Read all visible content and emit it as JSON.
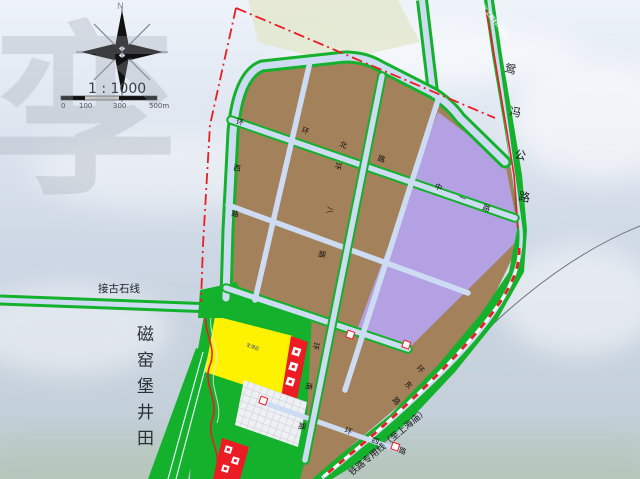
{
  "colors": {
    "sky-top": "#eef3fa",
    "sky-mid": "#ccd6e4",
    "horizon-haze": "#b5c6bb",
    "parcel-brown": "#a3815a",
    "parcel-purple": "#b3a1e3",
    "green": "#14b12c",
    "road-fill": "#cddcf2",
    "road-edge": "#aebdd4",
    "boundary-red": "#ec1c24",
    "block-yellow": "#fef200",
    "block-red": "#ec1c24",
    "hatch-white": "#eef0f3",
    "sage": "#e3e7cf",
    "ink": "#222222"
  },
  "compass": {
    "north_label": "N"
  },
  "scale": {
    "ratio_label": "1 : 1000",
    "tick_labels": [
      "0",
      "100",
      "300",
      "500m"
    ]
  },
  "watermark_char": "孪",
  "labels": [
    {
      "id": "watermark-char",
      "text": "孪",
      "x": -8,
      "y": 178,
      "size": 185,
      "color": "rgba(158,164,176,0.30)",
      "rot": 0,
      "bold": true
    },
    {
      "id": "compass-north-label",
      "text": "N",
      "x": 117,
      "y": 9,
      "size": 9,
      "color": "#8a94a4"
    },
    {
      "id": "scale-ratio",
      "text": "1 : 1000",
      "x": 88,
      "y": 93,
      "size": 14,
      "color": "#3a3f4a"
    },
    {
      "id": "scale-tick-0",
      "text": "0",
      "x": 61,
      "y": 108,
      "size": 7,
      "color": "#555555"
    },
    {
      "id": "scale-tick-100",
      "text": "100",
      "x": 79,
      "y": 108,
      "size": 7,
      "color": "#555555"
    },
    {
      "id": "scale-tick-300",
      "text": "300",
      "x": 113,
      "y": 108,
      "size": 7,
      "color": "#555555"
    },
    {
      "id": "scale-tick-500",
      "text": "500m",
      "x": 149,
      "y": 108,
      "size": 7,
      "color": "#555555"
    },
    {
      "id": "minefield-label",
      "text": "磁窑堡井田",
      "x": 137,
      "y": 340,
      "size": 17,
      "color": "#2b2f36",
      "vertical": true,
      "spacing": 26
    },
    {
      "id": "jiegushi-line-label",
      "text": "接古石线",
      "x": 98,
      "y": 292,
      "size": 10.5,
      "color": "#1d2126"
    },
    {
      "id": "highway-label",
      "text": "鸳冯公路",
      "size": 11.5,
      "color": "#1d2126",
      "rot": 10,
      "per_char": [
        [
          504,
          72
        ],
        [
          509,
          115
        ],
        [
          514,
          158
        ],
        [
          518,
          200
        ]
      ]
    },
    {
      "id": "industry-area-label",
      "text": "化工原料林园区",
      "x": 481,
      "y": 7,
      "size": 6,
      "color": "#ffffff",
      "rot": 52
    },
    {
      "id": "railway-label",
      "text": "铁路专用线（至上海庙）",
      "x": 352,
      "y": 476,
      "size": 9,
      "color": "#15181c",
      "rot": -40
    },
    {
      "id": "road-label-west-ring",
      "text": "环西路",
      "size": 7.5,
      "color": "#111111",
      "rot": 8,
      "per_char": [
        [
          236,
          124
        ],
        [
          233,
          170
        ],
        [
          231,
          216
        ]
      ]
    },
    {
      "id": "road-label-north-ring",
      "text": "环北路",
      "size": 7.5,
      "color": "#111111",
      "rot": 20,
      "per_char": [
        [
          301,
          132
        ],
        [
          339,
          146
        ],
        [
          377,
          160
        ]
      ]
    },
    {
      "id": "road-label-eight",
      "text": "环八路",
      "size": 7.5,
      "color": "#111111",
      "rot": 100,
      "per_char": [
        [
          336,
          162
        ],
        [
          328,
          206
        ],
        [
          320,
          250
        ]
      ]
    },
    {
      "id": "road-label-zhongyi",
      "text": "中一路",
      "size": 7.5,
      "color": "#111111",
      "rot": 23,
      "per_char": [
        [
          434,
          188
        ],
        [
          458,
          199
        ],
        [
          482,
          209
        ]
      ]
    },
    {
      "id": "road-label-south-ring",
      "text": "环南路",
      "size": 7.5,
      "color": "#111111",
      "rot": 100,
      "per_char": [
        [
          314,
          342
        ],
        [
          307,
          382
        ],
        [
          300,
          422
        ]
      ]
    },
    {
      "id": "road-label-east-ring",
      "text": "环东路",
      "size": 7.5,
      "color": "#111111",
      "rot": 48,
      "per_char": [
        [
          416,
          368
        ],
        [
          404,
          384
        ],
        [
          392,
          400
        ]
      ]
    },
    {
      "id": "road-label-four",
      "text": "环四路",
      "size": 7.5,
      "color": "#111111",
      "rot": 21,
      "per_char": [
        [
          344,
          432
        ],
        [
          371,
          442
        ],
        [
          398,
          452
        ]
      ]
    },
    {
      "id": "living-block-label",
      "text": "生活区",
      "x": 246,
      "y": 346,
      "size": 4.5,
      "color": "#1a2f8f",
      "rot": 20
    }
  ]
}
